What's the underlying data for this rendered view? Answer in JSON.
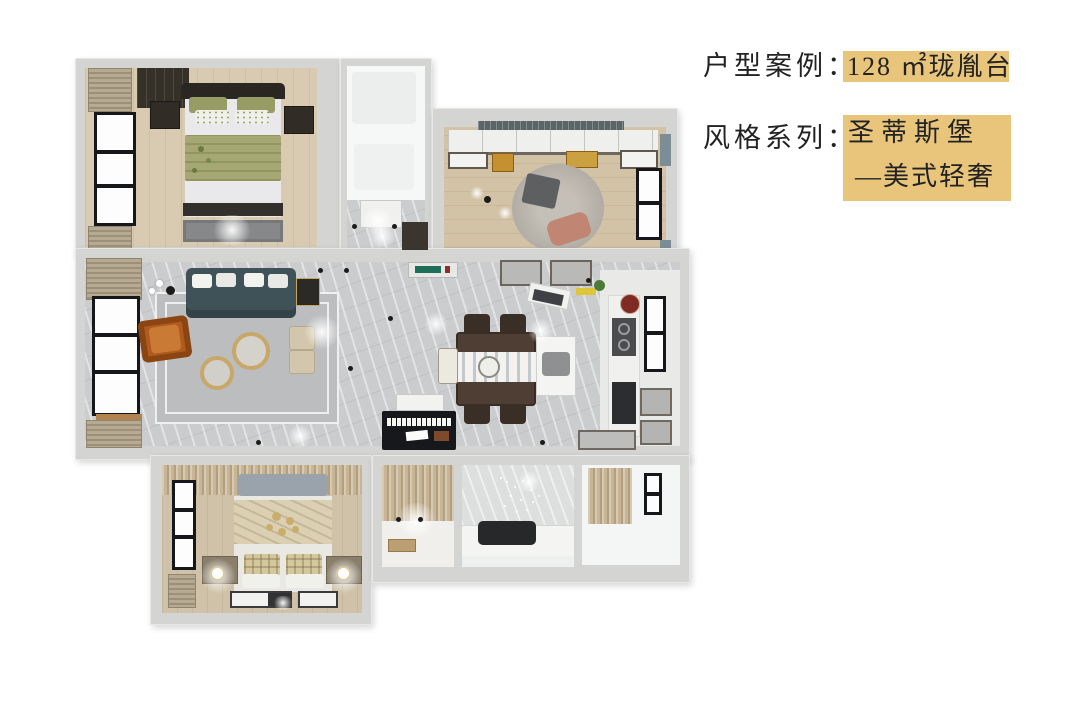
{
  "canvas": {
    "width": 1080,
    "height": 703,
    "background": "#ffffff"
  },
  "annotation": {
    "case_label": "户型案例：",
    "case_value": "128 ㎡珑胤台",
    "style_label": "风格系列：",
    "style_value_line1": "圣蒂斯堡",
    "style_value_line2": "—美式轻奢",
    "highlight_color": "#e8c57b",
    "text_color": "#222222"
  },
  "floorplan": {
    "view": "3d-top-down-apartment-render",
    "area_sqm": "128",
    "rooms": [
      "master-bedroom",
      "top-bathroom",
      "entry-corridor",
      "study-bedroom",
      "balcony",
      "living-room",
      "dining-room",
      "kitchen",
      "second-bedroom",
      "walk-in-closet",
      "second-bathroom",
      "utility-room"
    ],
    "palette": {
      "wall": "#d4d4d2",
      "marble_floor": "#cbccce",
      "wood_floor": "#d8cbb2",
      "sofa": "#3f5257",
      "accent_chair": "#b8641f",
      "gold_table": "#c8a86a",
      "master_bedding": "#a3a570",
      "window_frame": "#16171a"
    }
  }
}
